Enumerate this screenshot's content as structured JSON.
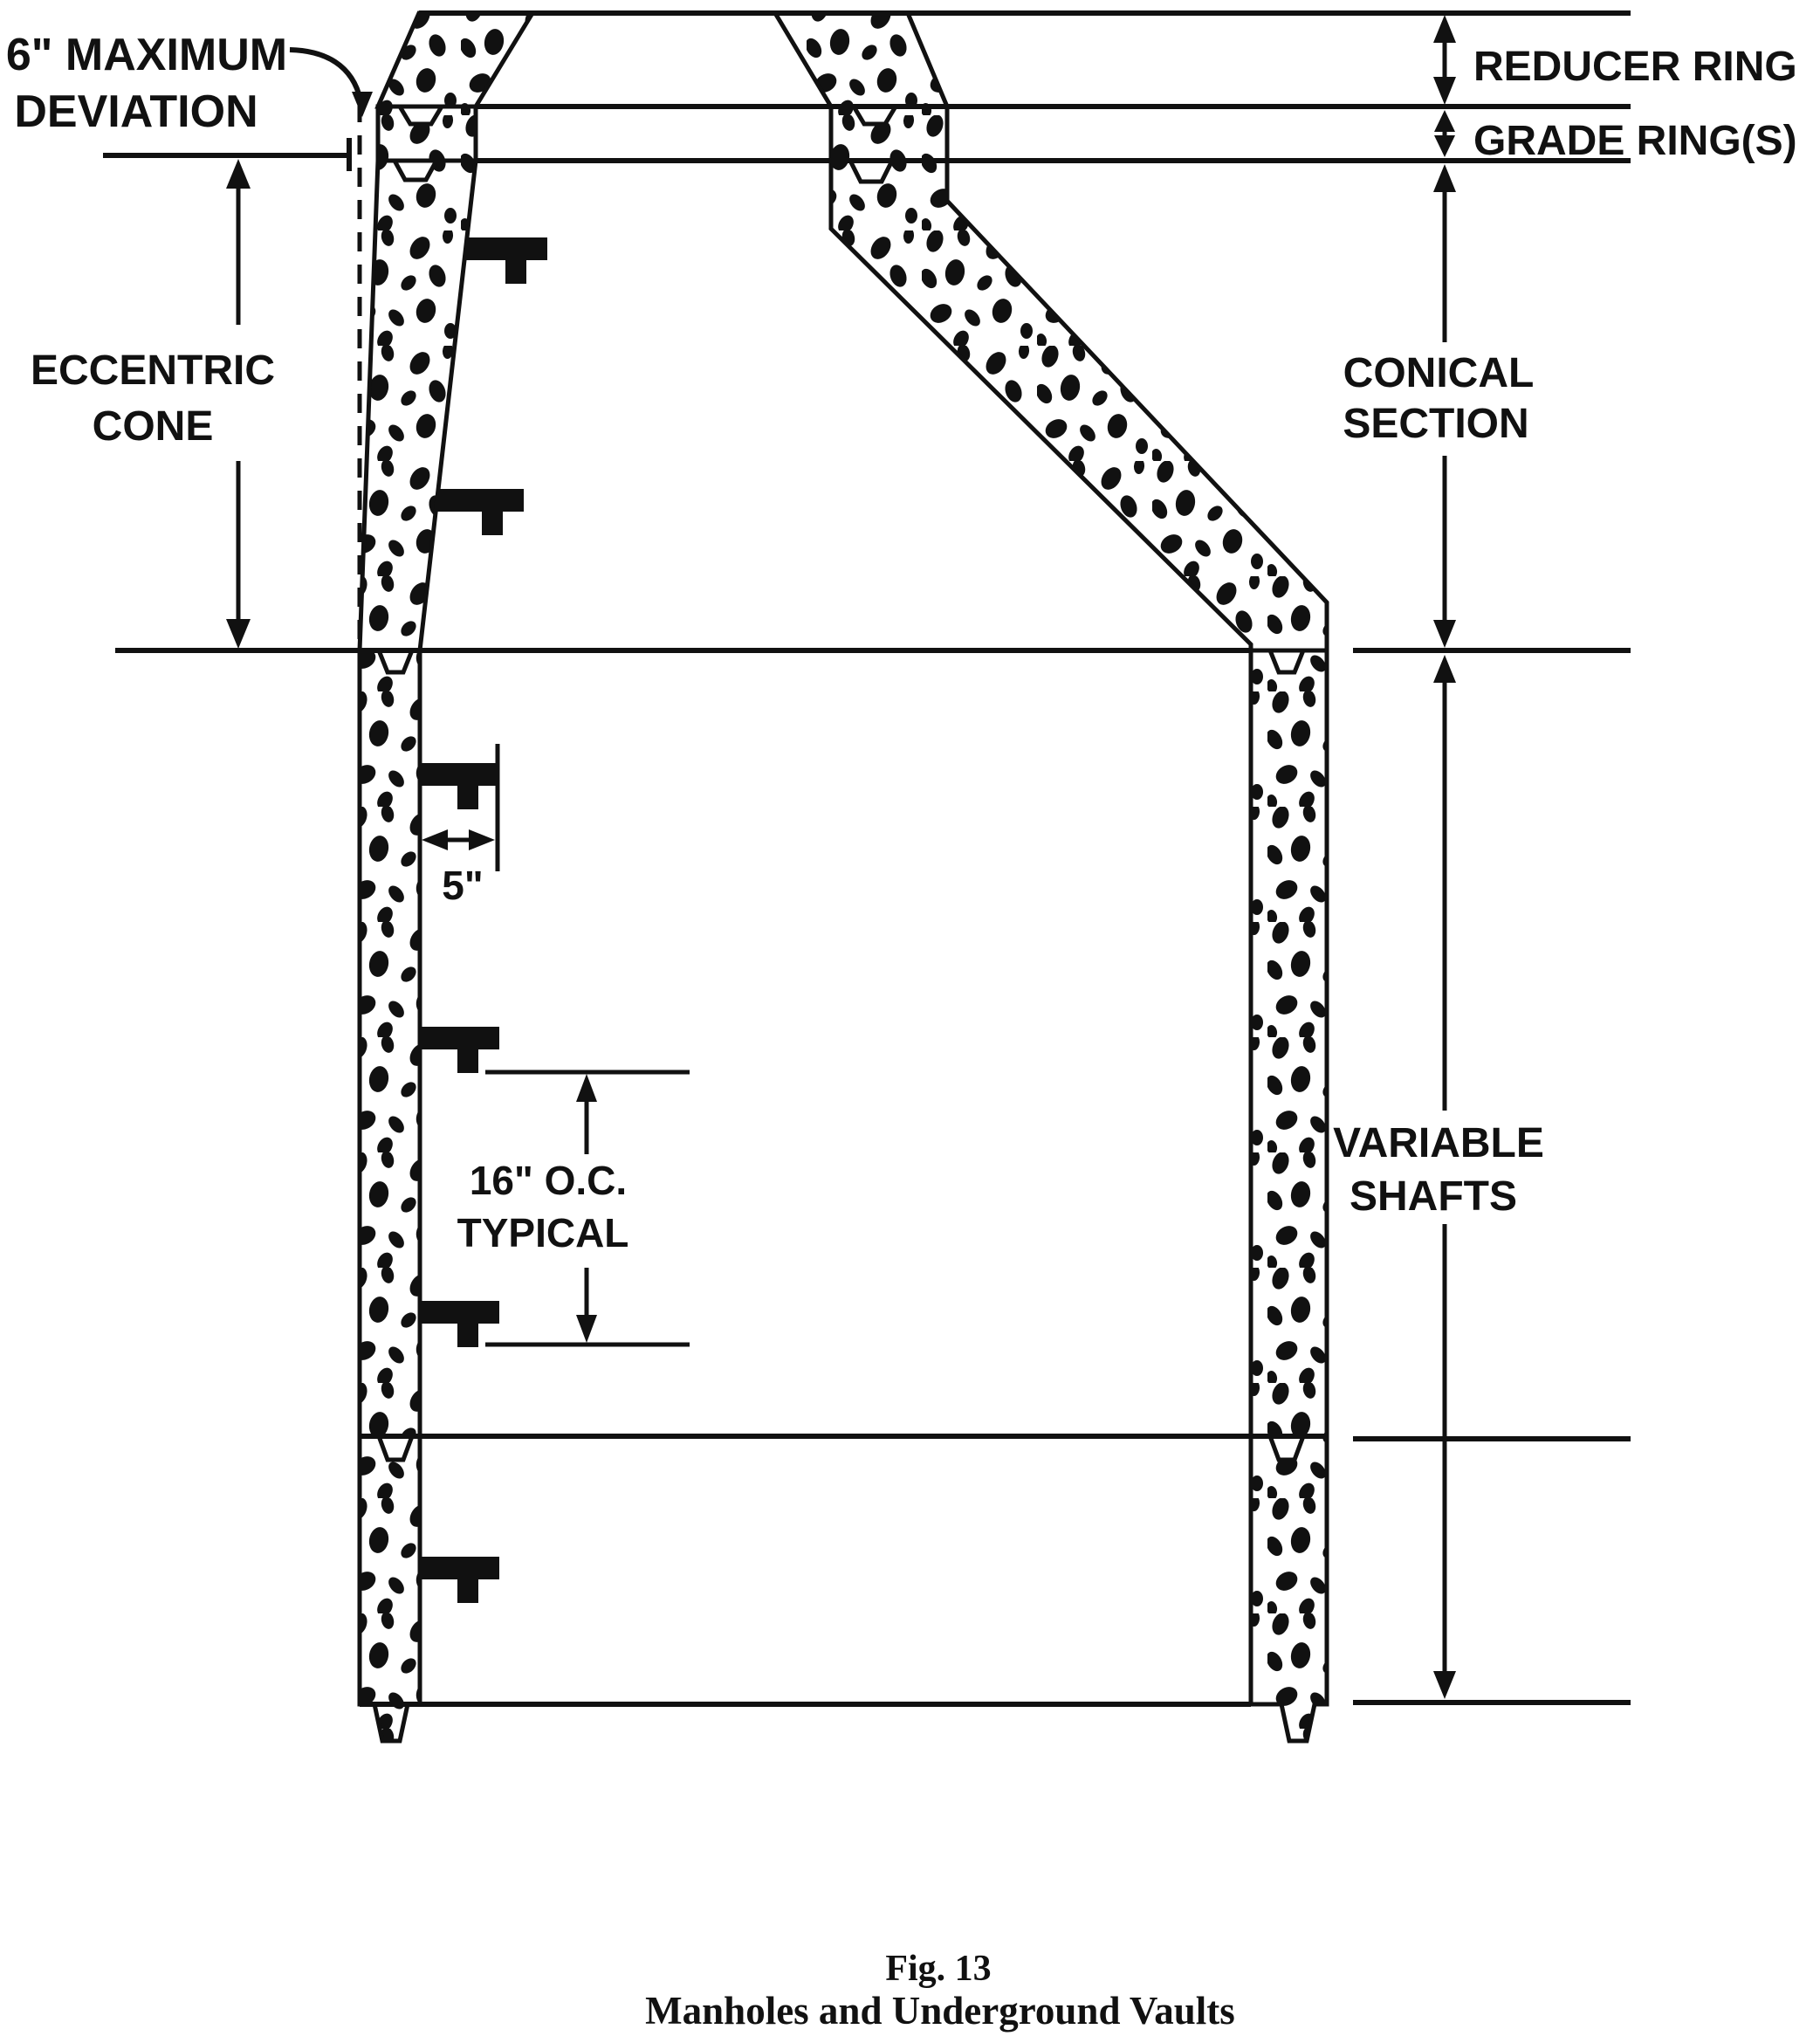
{
  "figure": {
    "caption_fig": "Fig. 13",
    "caption_title": "Manholes and Underground Vaults"
  },
  "labels": {
    "max_deviation_1": "6\" MAXIMUM",
    "max_deviation_2": "DEVIATION",
    "eccentric_1": "ECCENTRIC",
    "eccentric_2": "CONE",
    "reducer_ring": "REDUCER RING",
    "grade_rings": "GRADE RING(S)",
    "conical_1": "CONICAL",
    "conical_2": "SECTION",
    "variable_1": "VARIABLE",
    "variable_2": "SHAFTS",
    "rung_offset": "5\"",
    "rung_spacing_1": "16\" O.C.",
    "rung_spacing_2": "TYPICAL"
  },
  "colors": {
    "ink": "#111111",
    "paper": "#ffffff"
  }
}
